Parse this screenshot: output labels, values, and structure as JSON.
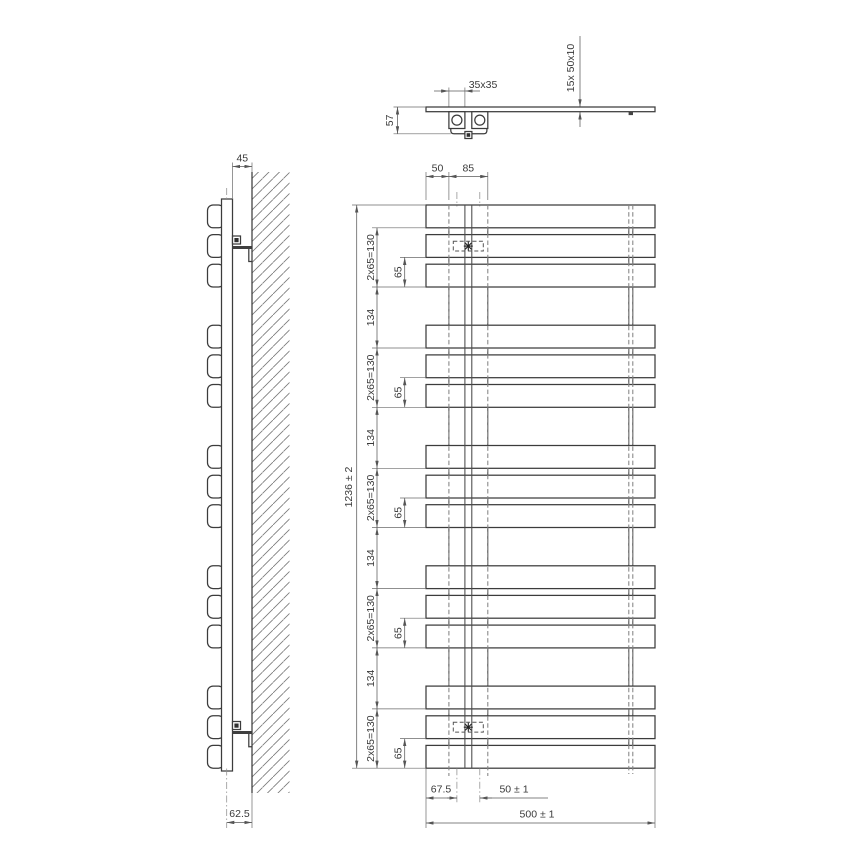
{
  "drawing": {
    "top_view": {
      "bracket_size": "35x35",
      "depth": "57",
      "tube_spec": "15x  50x10"
    },
    "side_view": {
      "wall_offset": "45",
      "bottom_offset": "62.5"
    },
    "front_view": {
      "top_dim_left": "50",
      "top_dim_right": "85",
      "overall_height": "1236 ± 2",
      "group_pitch": "2x65=130",
      "group_gap": "134",
      "bar_pitch": "65",
      "bottom_dim_left": "67.5",
      "bottom_dim_center": "50 ± 1",
      "overall_width": "500 ± 1"
    }
  }
}
